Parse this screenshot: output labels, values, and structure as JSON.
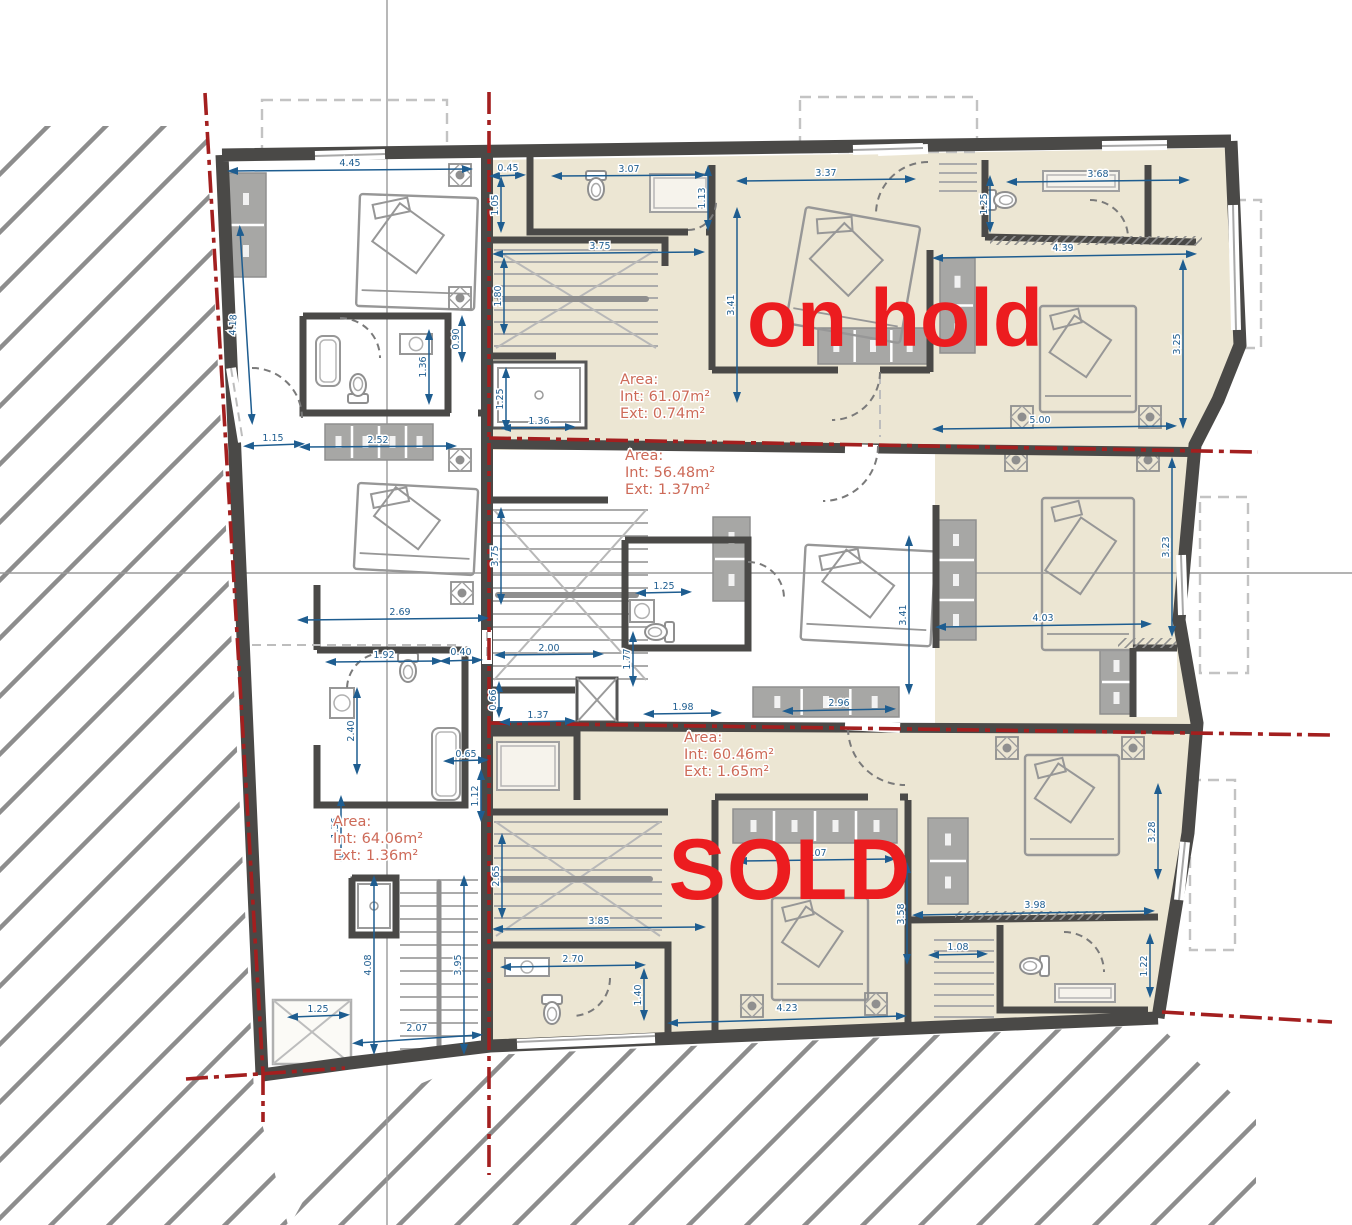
{
  "drawing": {
    "type": "architectural floor plan",
    "units": "m",
    "annotation_color": "#ec1c1f",
    "area_label_color": "#cd6a58",
    "dimension_color": "#1e5d90",
    "wall_color": "#4a4947",
    "floor_color": "#ece6d3",
    "boundary_color": "#a31f1f"
  },
  "annotations": {
    "on_hold": "on hold",
    "sold": "SOLD"
  },
  "area_labels": [
    {
      "id": "unit-top-right",
      "x": 620,
      "y": 384,
      "lines": [
        "Area:",
        "Int: 61.07m²",
        "Ext: 0.74m²"
      ]
    },
    {
      "id": "unit-middle",
      "x": 625,
      "y": 460,
      "lines": [
        "Area:",
        "Int: 56.48m²",
        "Ext: 1.37m²"
      ]
    },
    {
      "id": "unit-bottom",
      "x": 684,
      "y": 742,
      "lines": [
        "Area:",
        "Int: 60.46m²",
        "Ext: 1.65m²"
      ]
    },
    {
      "id": "unit-left",
      "x": 333,
      "y": 826,
      "lines": [
        "Area:",
        "Int: 64.06m²",
        "Ext: 1.36m²"
      ]
    }
  ],
  "dimensions": [
    {
      "t": "4.45",
      "x1": 232,
      "y1": 171,
      "x2": 468,
      "y2": 169,
      "lx": 350,
      "ly": 166
    },
    {
      "t": "4.18",
      "x1": 240,
      "y1": 230,
      "x2": 252,
      "y2": 420,
      "lx": 236,
      "ly": 325,
      "r": -87
    },
    {
      "t": "1.15",
      "x1": 248,
      "y1": 446,
      "x2": 300,
      "y2": 444,
      "lx": 273,
      "ly": 441
    },
    {
      "t": "2.52",
      "x1": 304,
      "y1": 447,
      "x2": 452,
      "y2": 446,
      "lx": 378,
      "ly": 443
    },
    {
      "t": "0.90",
      "x1": 462,
      "y1": 320,
      "x2": 462,
      "y2": 358,
      "lx": 459,
      "ly": 339,
      "r": -90
    },
    {
      "t": "1.36",
      "x1": 429,
      "y1": 334,
      "x2": 429,
      "y2": 400,
      "lx": 426,
      "ly": 367,
      "r": -90
    },
    {
      "t": "2.69",
      "x1": 302,
      "y1": 620,
      "x2": 484,
      "y2": 618,
      "lx": 400,
      "ly": 615
    },
    {
      "t": "1.92",
      "x1": 330,
      "y1": 662,
      "x2": 438,
      "y2": 661,
      "lx": 384,
      "ly": 658
    },
    {
      "t": "0.40",
      "x1": 444,
      "y1": 661,
      "x2": 478,
      "y2": 660,
      "lx": 461,
      "ly": 655
    },
    {
      "t": "2.40",
      "x1": 357,
      "y1": 692,
      "x2": 357,
      "y2": 770,
      "lx": 354,
      "ly": 731,
      "r": -90
    },
    {
      "t": "0.65",
      "x1": 448,
      "y1": 761,
      "x2": 484,
      "y2": 760,
      "lx": 466,
      "ly": 757
    },
    {
      "t": "1.12",
      "x1": 481,
      "y1": 774,
      "x2": 481,
      "y2": 817,
      "lx": 478,
      "ly": 796,
      "r": -90
    },
    {
      "t": "1.36",
      "x1": 341,
      "y1": 800,
      "x2": 341,
      "y2": 857,
      "lx": 338,
      "ly": 828,
      "r": -90
    },
    {
      "t": "4.08",
      "x1": 374,
      "y1": 880,
      "x2": 374,
      "y2": 1050,
      "lx": 371,
      "ly": 965,
      "r": -90
    },
    {
      "t": "3.95",
      "x1": 464,
      "y1": 880,
      "x2": 464,
      "y2": 1050,
      "lx": 461,
      "ly": 965,
      "r": -90
    },
    {
      "t": "1.25",
      "x1": 292,
      "y1": 1017,
      "x2": 345,
      "y2": 1015,
      "lx": 318,
      "ly": 1012
    },
    {
      "t": "2.07",
      "x1": 357,
      "y1": 1043,
      "x2": 478,
      "y2": 1035,
      "lx": 417,
      "ly": 1031
    },
    {
      "t": "0.45",
      "x1": 494,
      "y1": 176,
      "x2": 521,
      "y2": 175,
      "lx": 508,
      "ly": 171
    },
    {
      "t": "3.07",
      "x1": 556,
      "y1": 176,
      "x2": 701,
      "y2": 175,
      "lx": 629,
      "ly": 172
    },
    {
      "t": "1.05",
      "x1": 501,
      "y1": 181,
      "x2": 501,
      "y2": 228,
      "lx": 498,
      "ly": 205,
      "r": -90
    },
    {
      "t": "1.13",
      "x1": 708,
      "y1": 170,
      "x2": 708,
      "y2": 226,
      "lx": 705,
      "ly": 198,
      "r": -90
    },
    {
      "t": "3.75",
      "x1": 497,
      "y1": 254,
      "x2": 700,
      "y2": 252,
      "lx": 600,
      "ly": 249
    },
    {
      "t": "1.80",
      "x1": 504,
      "y1": 262,
      "x2": 504,
      "y2": 330,
      "lx": 501,
      "ly": 296,
      "r": -90
    },
    {
      "t": "3.41",
      "x1": 737,
      "y1": 212,
      "x2": 737,
      "y2": 398,
      "lx": 734,
      "ly": 305,
      "r": -90
    },
    {
      "t": "1.25",
      "x1": 506,
      "y1": 372,
      "x2": 506,
      "y2": 426,
      "lx": 503,
      "ly": 399,
      "r": -90
    },
    {
      "t": "1.36",
      "x1": 505,
      "y1": 428,
      "x2": 571,
      "y2": 427,
      "lx": 539,
      "ly": 424
    },
    {
      "t": "3.37",
      "x1": 741,
      "y1": 181,
      "x2": 911,
      "y2": 179,
      "lx": 826,
      "ly": 176
    },
    {
      "t": "3.68",
      "x1": 1011,
      "y1": 182,
      "x2": 1185,
      "y2": 180,
      "lx": 1098,
      "ly": 177
    },
    {
      "t": "1.25",
      "x1": 990,
      "y1": 180,
      "x2": 990,
      "y2": 228,
      "lx": 987,
      "ly": 204,
      "r": -90
    },
    {
      "t": "4.39",
      "x1": 937,
      "y1": 258,
      "x2": 1192,
      "y2": 254,
      "lx": 1063,
      "ly": 251
    },
    {
      "t": "3.25",
      "x1": 1183,
      "y1": 264,
      "x2": 1183,
      "y2": 424,
      "lx": 1180,
      "ly": 344,
      "r": -90
    },
    {
      "t": "5.00",
      "x1": 937,
      "y1": 429,
      "x2": 1172,
      "y2": 426,
      "lx": 1040,
      "ly": 423
    },
    {
      "t": "3.75",
      "x1": 501,
      "y1": 512,
      "x2": 501,
      "y2": 600,
      "lx": 498,
      "ly": 556,
      "r": -90
    },
    {
      "t": "2.00",
      "x1": 499,
      "y1": 655,
      "x2": 599,
      "y2": 654,
      "lx": 549,
      "ly": 651
    },
    {
      "t": "0.66",
      "x1": 499,
      "y1": 686,
      "x2": 499,
      "y2": 713,
      "lx": 496,
      "ly": 700,
      "r": -90
    },
    {
      "t": "1.37",
      "x1": 504,
      "y1": 722,
      "x2": 571,
      "y2": 721,
      "lx": 538,
      "ly": 718
    },
    {
      "t": "1.25",
      "x1": 640,
      "y1": 593,
      "x2": 687,
      "y2": 592,
      "lx": 664,
      "ly": 589
    },
    {
      "t": "1.77",
      "x1": 633,
      "y1": 636,
      "x2": 633,
      "y2": 682,
      "lx": 630,
      "ly": 659,
      "r": -90
    },
    {
      "t": "1.98",
      "x1": 648,
      "y1": 714,
      "x2": 717,
      "y2": 713,
      "lx": 683,
      "ly": 710
    },
    {
      "t": "2.96",
      "x1": 787,
      "y1": 711,
      "x2": 891,
      "y2": 709,
      "lx": 839,
      "ly": 706
    },
    {
      "t": "3.41",
      "x1": 909,
      "y1": 540,
      "x2": 909,
      "y2": 690,
      "lx": 906,
      "ly": 615,
      "r": -90
    },
    {
      "t": "4.03",
      "x1": 940,
      "y1": 627,
      "x2": 1147,
      "y2": 624,
      "lx": 1043,
      "ly": 621
    },
    {
      "t": "3.23",
      "x1": 1172,
      "y1": 462,
      "x2": 1172,
      "y2": 632,
      "lx": 1169,
      "ly": 547,
      "r": -90
    },
    {
      "t": "2.65",
      "x1": 502,
      "y1": 838,
      "x2": 502,
      "y2": 914,
      "lx": 499,
      "ly": 876,
      "r": -90
    },
    {
      "t": "3.85",
      "x1": 497,
      "y1": 929,
      "x2": 701,
      "y2": 927,
      "lx": 599,
      "ly": 924
    },
    {
      "t": "2.70",
      "x1": 505,
      "y1": 967,
      "x2": 641,
      "y2": 965,
      "lx": 573,
      "ly": 962
    },
    {
      "t": "1.40",
      "x1": 644,
      "y1": 973,
      "x2": 644,
      "y2": 1016,
      "lx": 641,
      "ly": 995,
      "r": -90
    },
    {
      "t": "3.07",
      "x1": 741,
      "y1": 861,
      "x2": 891,
      "y2": 859,
      "lx": 816,
      "ly": 856
    },
    {
      "t": "3.58",
      "x1": 907,
      "y1": 867,
      "x2": 907,
      "y2": 960,
      "lx": 904,
      "ly": 914,
      "r": -90
    },
    {
      "t": "3.98",
      "x1": 917,
      "y1": 915,
      "x2": 1150,
      "y2": 911,
      "lx": 1035,
      "ly": 908
    },
    {
      "t": "4.23",
      "x1": 672,
      "y1": 1023,
      "x2": 902,
      "y2": 1016,
      "lx": 787,
      "ly": 1011
    },
    {
      "t": "1.08",
      "x1": 933,
      "y1": 955,
      "x2": 983,
      "y2": 954,
      "lx": 958,
      "ly": 950
    },
    {
      "t": "1.22",
      "x1": 1150,
      "y1": 938,
      "x2": 1150,
      "y2": 993,
      "lx": 1147,
      "ly": 966,
      "r": -90
    },
    {
      "t": "3.28",
      "x1": 1158,
      "y1": 788,
      "x2": 1158,
      "y2": 875,
      "lx": 1155,
      "ly": 832,
      "r": -90
    }
  ],
  "symbols": {
    "beds": [
      {
        "x": 358,
        "y": 196,
        "w": 118,
        "h": 112,
        "r": 2
      },
      {
        "x": 356,
        "y": 486,
        "w": 120,
        "h": 86,
        "r": 3
      },
      {
        "x": 795,
        "y": 216,
        "w": 116,
        "h": 118,
        "r": 10
      },
      {
        "x": 1040,
        "y": 306,
        "w": 96,
        "h": 106,
        "r": 0
      },
      {
        "x": 803,
        "y": 548,
        "w": 130,
        "h": 95,
        "r": 3
      },
      {
        "x": 1042,
        "y": 498,
        "w": 92,
        "h": 152,
        "r": 0
      },
      {
        "x": 772,
        "y": 898,
        "w": 96,
        "h": 102,
        "r": 0
      },
      {
        "x": 1025,
        "y": 755,
        "w": 94,
        "h": 100,
        "r": 0
      }
    ],
    "toilets": [
      [
        358,
        384,
        180
      ],
      [
        408,
        672,
        0
      ],
      [
        596,
        190,
        0
      ],
      [
        655,
        632,
        90
      ],
      [
        552,
        1014,
        0
      ],
      [
        1030,
        966,
        90
      ],
      [
        1006,
        200,
        -90
      ]
    ],
    "wardrobes": [
      {
        "x": 226,
        "y": 173,
        "w": 40,
        "h": 104,
        "c": 2
      },
      {
        "x": 325,
        "y": 424,
        "w": 108,
        "h": 36,
        "c": 4
      },
      {
        "x": 818,
        "y": 328,
        "w": 110,
        "h": 36,
        "c": 3
      },
      {
        "x": 713,
        "y": 517,
        "w": 37,
        "h": 84,
        "c": 2
      },
      {
        "x": 936,
        "y": 520,
        "w": 40,
        "h": 120,
        "c": 3
      },
      {
        "x": 753,
        "y": 687,
        "w": 146,
        "h": 30,
        "c": 3
      },
      {
        "x": 733,
        "y": 809,
        "w": 164,
        "h": 34,
        "c": 4
      },
      {
        "x": 928,
        "y": 818,
        "w": 40,
        "h": 86,
        "c": 2
      },
      {
        "x": 940,
        "y": 258,
        "w": 35,
        "h": 95,
        "c": 2
      },
      {
        "x": 1100,
        "y": 650,
        "w": 33,
        "h": 64,
        "c": 2
      }
    ],
    "counters": [
      {
        "x": 1043,
        "y": 171,
        "w": 76,
        "h": 20,
        "c": 2
      },
      {
        "x": 650,
        "y": 174,
        "w": 60,
        "h": 38,
        "c": 2
      },
      {
        "x": 497,
        "y": 742,
        "w": 62,
        "h": 48,
        "c": 2
      },
      {
        "x": 1055,
        "y": 984,
        "w": 60,
        "h": 18,
        "c": 2
      }
    ],
    "fans": [
      [
        460,
        175
      ],
      [
        460,
        298
      ],
      [
        460,
        460
      ],
      [
        462,
        593
      ],
      [
        1022,
        417
      ],
      [
        1150,
        417
      ],
      [
        1016,
        460
      ],
      [
        1148,
        460
      ],
      [
        752,
        1006
      ],
      [
        876,
        1004
      ],
      [
        1007,
        748
      ],
      [
        1133,
        748
      ]
    ],
    "stairs": [
      {
        "x": 492,
        "y": 246,
        "w": 168,
        "h": 106,
        "s": 12,
        "d": 1,
        "rail": "h"
      },
      {
        "x": 490,
        "y": 506,
        "w": 160,
        "h": 178,
        "s": 13,
        "d": 1,
        "rail": "h"
      },
      {
        "x": 398,
        "y": 876,
        "w": 82,
        "h": 176,
        "s": 13,
        "d": 0,
        "rail": "v"
      },
      {
        "x": 492,
        "y": 818,
        "w": 172,
        "h": 122,
        "s": 12,
        "d": 1,
        "rail": "h"
      },
      {
        "x": 932,
        "y": 936,
        "w": 64,
        "h": 92,
        "s": 11,
        "d": 0,
        "rail": ""
      },
      {
        "x": 937,
        "y": 160,
        "w": 42,
        "h": 36,
        "s": 9,
        "d": 0,
        "rail": ""
      }
    ],
    "elevators": [
      {
        "x": 492,
        "y": 362,
        "w": 94,
        "h": 66,
        "t": "lift"
      },
      {
        "x": 577,
        "y": 678,
        "w": 40,
        "h": 44,
        "t": "x"
      },
      {
        "x": 273,
        "y": 1000,
        "w": 78,
        "h": 64,
        "t": "xlight"
      },
      {
        "x": 352,
        "y": 878,
        "w": 44,
        "h": 56,
        "t": "lift"
      }
    ],
    "tubs": [
      {
        "x": 316,
        "y": 336,
        "w": 24,
        "h": 50
      },
      {
        "x": 432,
        "y": 728,
        "w": 28,
        "h": 72
      }
    ],
    "sinks": [
      {
        "x": 400,
        "y": 334,
        "w": 32,
        "h": 20
      },
      {
        "x": 330,
        "y": 688,
        "w": 24,
        "h": 30
      },
      {
        "x": 630,
        "y": 600,
        "w": 24,
        "h": 22
      },
      {
        "x": 505,
        "y": 958,
        "w": 44,
        "h": 18
      }
    ]
  }
}
